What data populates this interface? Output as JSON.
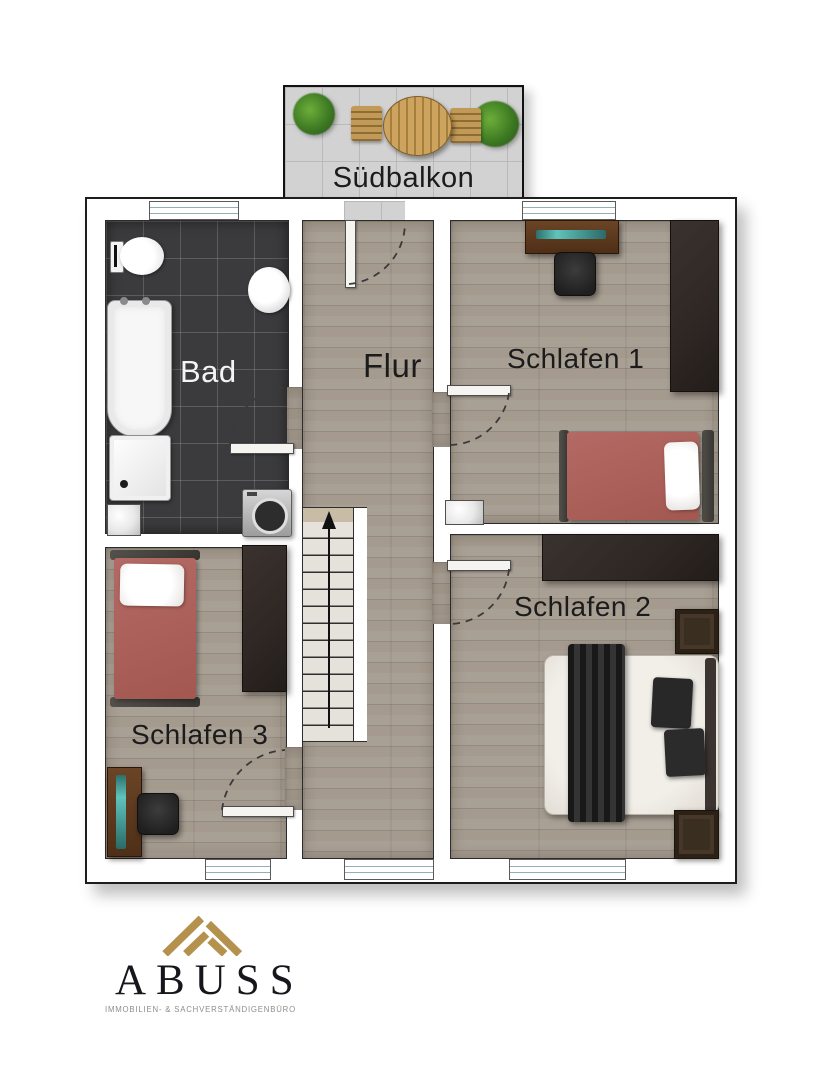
{
  "floorplan": {
    "balcony": {
      "label": "Südbalkon"
    },
    "rooms": {
      "bad": {
        "label": "Bad"
      },
      "flur": {
        "label": "Flur"
      },
      "schlafen1": {
        "label": "Schlafen 1"
      },
      "schlafen2": {
        "label": "Schlafen 2"
      },
      "schlafen3": {
        "label": "Schlafen 3"
      }
    }
  },
  "branding": {
    "company": "ABUSS",
    "tagline": "IMMOBILIEN- & SACHVERSTÄNDIGENBÜRO"
  },
  "colors": {
    "wood_floor": "#a49a8e",
    "bath_tile": "#3b3b3d",
    "balcony_tile": "#d2d2d2",
    "bed_red": "#ac5f5a",
    "furniture_dark": "#2e2724",
    "logo_gold": "#b5914e"
  }
}
